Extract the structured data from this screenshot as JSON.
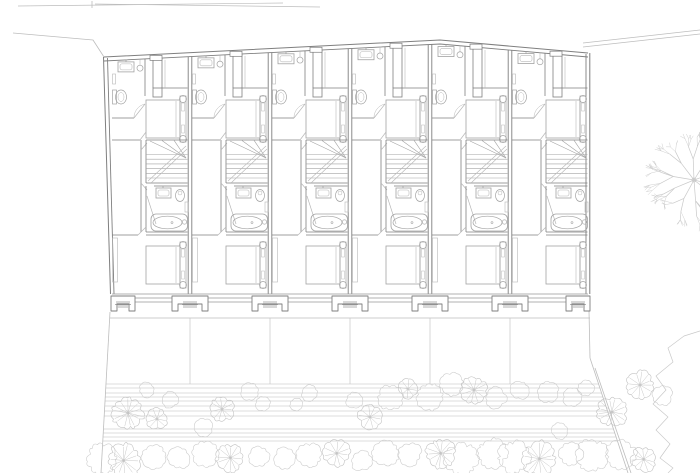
{
  "document": {
    "type": "architectural-site-plan",
    "description": "row-house floor plan with six identical units and rear garden",
    "background": "#ffffff"
  },
  "palette": {
    "wall": "#7f7f7f",
    "wall_soft": "#999999",
    "fixture": "#a3a3a3",
    "fixture_light": "#b8b8b8",
    "site": "#bdbdbd",
    "plant": "#cdcdcd",
    "plant_dark": "#c2c2c2",
    "tree": "#c9c9c9",
    "paper": "#ffffff"
  },
  "building": {
    "units_count": 6,
    "party_walls_x": [
      110,
      190,
      270,
      350,
      430,
      510,
      590
    ],
    "top_profile": [
      [
        104,
        57
      ],
      [
        440,
        40
      ],
      [
        588,
        53
      ]
    ],
    "interior_floor_y": 294,
    "glazing_y": [
      298,
      302
    ],
    "pier_bottom_y": 311,
    "piers": [
      {
        "x": 123,
        "half": 12
      },
      {
        "x": 190,
        "half": 18
      },
      {
        "x": 270,
        "half": 18
      },
      {
        "x": 350,
        "half": 18
      },
      {
        "x": 430,
        "half": 18
      },
      {
        "x": 510,
        "half": 18
      },
      {
        "x": 578,
        "half": 12
      }
    ],
    "rooms_per_unit": [
      "bathroom",
      "bedroom",
      "hall-staircase",
      "bathroom",
      "bedroom"
    ],
    "fixtures_per_unit": [
      "wash-basin",
      "pendant-light",
      "toilet",
      "shaft",
      "wardrobe",
      "double-bed",
      "winder-staircase",
      "wash-basin",
      "toilet",
      "bathtub",
      "radiator",
      "double-bed"
    ]
  },
  "site": {
    "top_edge_lines": [
      [
        18,
        6,
        283,
        3
      ],
      [
        95,
        4,
        320,
        7
      ]
    ],
    "top_edge_tick": [
      92,
      1,
      92,
      8
    ],
    "boundary_top_left": [
      [
        13,
        33
      ],
      [
        93,
        40
      ],
      [
        104,
        57
      ]
    ],
    "boundary_left": [
      [
        110,
        312
      ],
      [
        101,
        473
      ]
    ],
    "road_top_right": [
      [
        583,
        43,
        700,
        30
      ],
      [
        583,
        47,
        700,
        34
      ]
    ],
    "boundary_right_wall": [
      589,
      311,
      590,
      358
    ],
    "boundary_right_diag": [
      [
        590,
        358,
        628,
        473
      ],
      [
        595,
        368,
        631,
        473
      ]
    ],
    "terrace_line_y": 318,
    "plot_dividers_x": [
      190,
      270,
      350,
      430,
      510
    ],
    "plot_dividers_y": [
      318,
      384
    ],
    "deck_lines_y": [
      384,
      388,
      393,
      397,
      401,
      406,
      411,
      416,
      429,
      433,
      437,
      441
    ],
    "canopy_plants": [
      {
        "x": 128,
        "y": 413,
        "r": 15,
        "style": "radial"
      },
      {
        "x": 157,
        "y": 419,
        "r": 10,
        "style": "radial"
      },
      {
        "x": 146,
        "y": 390,
        "r": 7,
        "style": "fluffy"
      },
      {
        "x": 170,
        "y": 400,
        "r": 8,
        "style": "fluffy"
      },
      {
        "x": 204,
        "y": 428,
        "r": 9,
        "style": "fluffy"
      },
      {
        "x": 222,
        "y": 409,
        "r": 12,
        "style": "radial"
      },
      {
        "x": 250,
        "y": 392,
        "r": 9,
        "style": "fluffy"
      },
      {
        "x": 263,
        "y": 404,
        "r": 7,
        "style": "fluffy"
      },
      {
        "x": 296,
        "y": 404,
        "r": 6,
        "style": "fluffy"
      },
      {
        "x": 310,
        "y": 393,
        "r": 8,
        "style": "fluffy"
      },
      {
        "x": 354,
        "y": 400,
        "r": 8,
        "style": "fluffy"
      },
      {
        "x": 370,
        "y": 417,
        "r": 11,
        "style": "radial"
      },
      {
        "x": 390,
        "y": 398,
        "r": 12,
        "style": "fluffy"
      },
      {
        "x": 408,
        "y": 389,
        "r": 9,
        "style": "radial"
      },
      {
        "x": 430,
        "y": 396,
        "r": 13,
        "style": "fluffy"
      },
      {
        "x": 452,
        "y": 384,
        "r": 11,
        "style": "fluffy"
      },
      {
        "x": 474,
        "y": 390,
        "r": 13,
        "style": "radial"
      },
      {
        "x": 496,
        "y": 398,
        "r": 10,
        "style": "fluffy"
      },
      {
        "x": 520,
        "y": 390,
        "r": 9,
        "style": "fluffy"
      },
      {
        "x": 548,
        "y": 392,
        "r": 10,
        "style": "fluffy"
      },
      {
        "x": 560,
        "y": 431,
        "r": 8,
        "style": "fluffy"
      },
      {
        "x": 572,
        "y": 398,
        "r": 9,
        "style": "fluffy"
      },
      {
        "x": 586,
        "y": 388,
        "r": 8,
        "style": "fluffy"
      },
      {
        "x": 612,
        "y": 412,
        "r": 14,
        "style": "radial"
      },
      {
        "x": 640,
        "y": 385,
        "r": 13,
        "style": "radial"
      },
      {
        "x": 662,
        "y": 396,
        "r": 10,
        "style": "fluffy"
      }
    ],
    "hedge_row": {
      "x_start": 100,
      "x_end": 650,
      "step": 26,
      "y": 457,
      "r_min": 10,
      "r_max": 16
    },
    "large_tree": {
      "cx": 694,
      "cy": 180,
      "r": 50
    },
    "thicket_edge": [
      [
        700,
        331
      ],
      [
        684,
        336
      ],
      [
        668,
        348
      ],
      [
        673,
        362
      ],
      [
        656,
        376
      ],
      [
        666,
        390
      ],
      [
        653,
        404
      ],
      [
        668,
        417
      ],
      [
        656,
        430
      ],
      [
        670,
        444
      ],
      [
        660,
        458
      ],
      [
        673,
        468
      ],
      [
        668,
        473
      ]
    ]
  }
}
